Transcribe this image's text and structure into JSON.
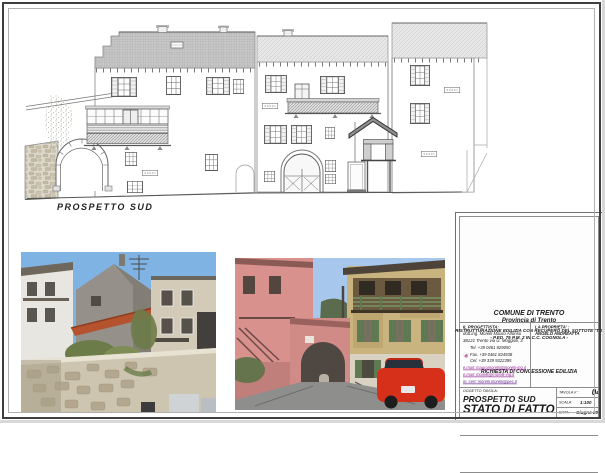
{
  "sheet": {
    "drawing_caption": "PROSPETTO SUD"
  },
  "title_block": {
    "header": {
      "municipality": "COMUNE DI TRENTO",
      "province": "Provincia di Trento"
    },
    "project": {
      "line1": "RISTRUTTURAZIONE EDILIZIA CON RECUPERO DEL SOTTOTETTO",
      "line2": "- P.ED. 75 P.M. 2 IN C.C. COGNOLA -"
    },
    "request": "RICHIESTA DI CONCESSIONE EDILIZIA",
    "designer": {
      "label": "IL PROGETTISTA:",
      "name": "dott.ing. Morelli Mauro Alfonso",
      "address": "38121 Trento via U. Moggioli, 3",
      "tel": "Tel. +39 0461 829050",
      "fax": "Fax. +39 0461 824938",
      "cell": "Cel. +39 339 9322395",
      "email1": "e.mail: mauromorelli@morelli-ing.it",
      "email2": "e.mail: morelli@morelli-ing.it",
      "pec": "m. cert: morelli.morelli@pec.it"
    },
    "owner": {
      "label": "LA PROPRIETA' :",
      "name": "ANGELO ANDREATTA"
    },
    "subject": {
      "label": "OGGETTO TAVOLA:",
      "line1": "PROSPETTO SUD",
      "line2": "STATO DI FATTO"
    },
    "meta": {
      "tavola_label": "TAVOLA n°:",
      "tavola_value": "04",
      "scala_label": "SCALA:",
      "scala_value": "1:100",
      "data_label": "DATA:",
      "data_value": "Giugno 2013"
    }
  },
  "colors": {
    "email_link": "#942a94",
    "logo_magenta": "#b53584",
    "photo_sky": "#7fb3e3",
    "photo_roof_tile": "#b5532e",
    "photo_car_red": "#d6301a",
    "photo_shutter_green": "#5f7a52",
    "photo_pink_house": "#d8918c"
  }
}
